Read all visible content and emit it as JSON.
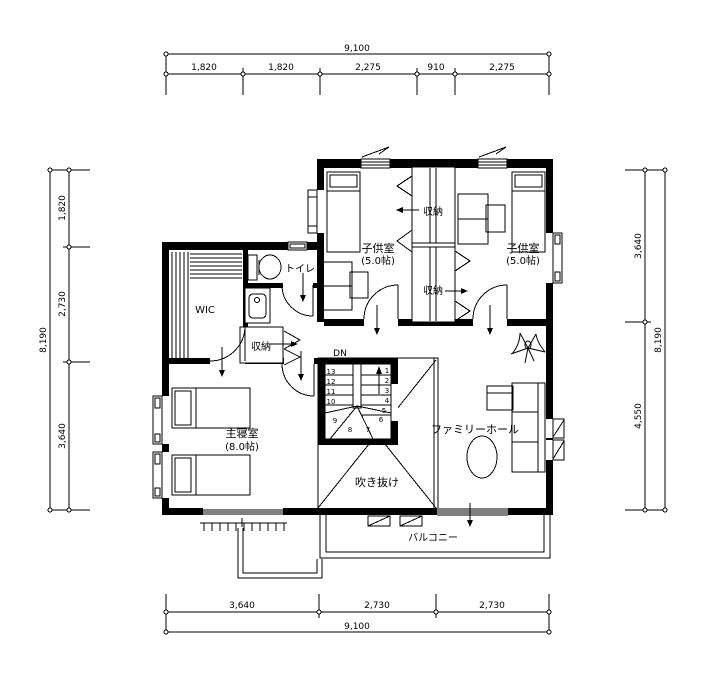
{
  "dimensions": {
    "top": {
      "total": "9,100",
      "segments": [
        "1,820",
        "1,820",
        "2,275",
        "910",
        "2,275"
      ]
    },
    "bottom": {
      "total": "9,100",
      "segments": [
        "3,640",
        "2,730",
        "2,730"
      ]
    },
    "left": {
      "total": "8,190",
      "segments": [
        "1,820",
        "2,730",
        "3,640"
      ]
    },
    "right": {
      "total": "8,190",
      "segments": [
        "3,640",
        "4,550"
      ]
    }
  },
  "rooms": {
    "kids_left": {
      "name": "子供室",
      "size": "(5.0帖)"
    },
    "kids_right": {
      "name": "子供室",
      "size": "(5.0帖)"
    },
    "closet_upper": {
      "name": "収納"
    },
    "closet_lower": {
      "name": "収納"
    },
    "closet_hall": {
      "name": "収納"
    },
    "toilet": {
      "name": "トイレ"
    },
    "wic": {
      "name": "WIC"
    },
    "master": {
      "name": "主寝室",
      "size": "(8.0帖)"
    },
    "family_hall": {
      "name": "ファミリーホール"
    },
    "void": {
      "name": "吹き抜け"
    },
    "balcony": {
      "name": "バルコニー"
    }
  },
  "stairs": {
    "label": "DN",
    "numbers_left": [
      "13",
      "12",
      "11",
      "10"
    ],
    "numbers_right": [
      "1",
      "2",
      "3",
      "4",
      "5"
    ],
    "numbers_turn": [
      "9",
      "8",
      "7",
      "6"
    ]
  },
  "colors": {
    "line": "#000000",
    "background": "#ffffff"
  }
}
